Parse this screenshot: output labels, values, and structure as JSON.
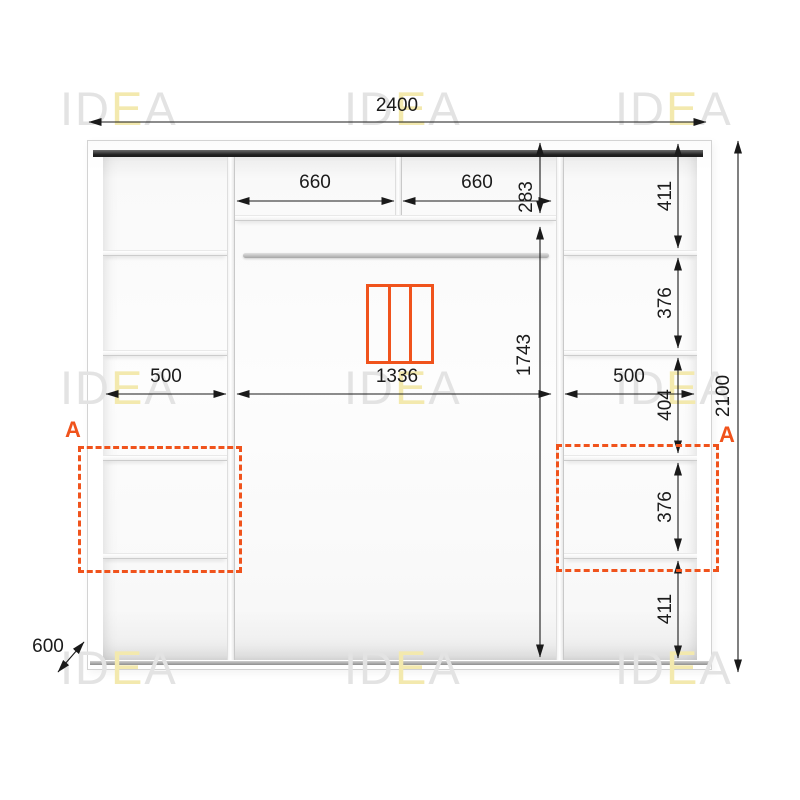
{
  "brand": {
    "gray1": "ID",
    "yellow": "E",
    "gray2": "A"
  },
  "dims": {
    "total_width": "2400",
    "total_height": "2100",
    "depth": "600",
    "top_left": "660",
    "top_right": "660",
    "top_height": "283",
    "hang_height": "1743",
    "left_width": "500",
    "center_width": "1336",
    "right_width": "500",
    "right_sections": [
      "411",
      "376",
      "404",
      "376",
      "411"
    ]
  },
  "annotations": {
    "marker_left": "A",
    "marker_right": "A"
  },
  "colors": {
    "accent_orange": "#F0531C",
    "dim_line": "#1a1a1a",
    "watermark_gray": "#e3e3e3",
    "watermark_yellow": "#f3e9ae",
    "top_rail_dark": "#1e1e1e"
  }
}
